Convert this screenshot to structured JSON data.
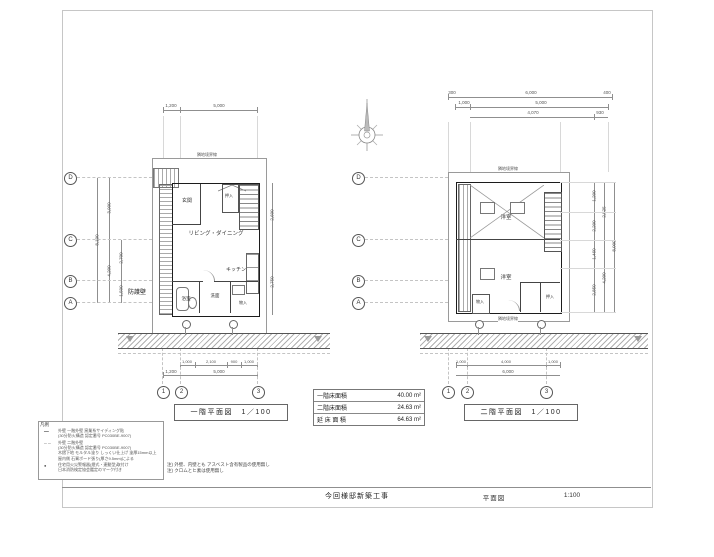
{
  "sheet": {
    "project_title": "今回様邸新築工事",
    "drawing_title": "平面図",
    "scale": "1:100"
  },
  "area_table": {
    "rows": [
      {
        "label": "一階床面積",
        "value": "40.00 m²"
      },
      {
        "label": "二階床面積",
        "value": "24.63 m²"
      },
      {
        "label": "延 床 面 積",
        "value": "64.63 m²"
      }
    ]
  },
  "plan1": {
    "caption": "一階平面図　1／100",
    "boundary_top": "隣地境界線",
    "guard_wall": "防護壁",
    "rooms": {
      "genkan": "玄関",
      "ld": "リビング・ダイニング",
      "kitchen": "キッチン",
      "oshiire": "押入",
      "bath": "浴室",
      "senmen": "洗面",
      "mono": "物入"
    },
    "grid": {
      "d": "D",
      "c": "C",
      "b": "B",
      "a": "A",
      "n1": "1",
      "n2": "2",
      "n3": "3"
    },
    "dims": {
      "top1": "1,200",
      "top2": "5,000",
      "left_total": "8,100",
      "left_u": "3,900",
      "left_l": "4,200",
      "left_l1": "2,700",
      "left_l2": "1,500",
      "right1": "2,600",
      "right2": "2,750",
      "b11": "1,000",
      "b12": "2,100",
      "b13": "900",
      "b14": "1,000",
      "b21": "1,200",
      "b22": "5,000"
    }
  },
  "plan2": {
    "caption": "二階平面図　1／100",
    "boundary_top": "隣地境界線",
    "boundary_bottom": "隣地境界線",
    "rooms": {
      "room_up": "洋室",
      "room_low": "洋室",
      "oshiire": "押入",
      "mono": "物入"
    },
    "grid": {
      "d": "D",
      "c": "C",
      "b": "B",
      "a": "A",
      "n1": "1",
      "n2": "2",
      "n3": "3"
    },
    "dims": {
      "t11": "300",
      "t12": "6,000",
      "t13": "400",
      "t21": "1,000",
      "t22": "5,000",
      "t31": "4,070",
      "t32": "930",
      "r11": "1,200",
      "r12": "2,200",
      "r13": "1,460",
      "r14": "2,850",
      "r21": "2,525",
      "r22": "4,200",
      "r3": "8,000",
      "b11": "1,000",
      "b12": "4,000",
      "b13": "1,000",
      "b2": "6,000"
    }
  },
  "legend": {
    "title": "凡例",
    "rows": [
      {
        "symbol": "━━",
        "text": "外壁 一階外壁 窯業系サイディング貼\n(30分防火構造 認定番号 PC030BE-9007)"
      },
      {
        "symbol": "─ ─",
        "text": "外壁 二階外壁\n(30分防火構造 認定番号 PC030BE-9007)\n木摺下地 モルタル塗り しっくい仕上げ 塗厚15mm以上\n屋内側 石膏ボード張り(厚さ9.5mm)による"
      },
      {
        "symbol": "●",
        "text": "住宅用火災警報器(煙式・連動型)取付け\n日本消防検定協会鑑定のマーク付き"
      }
    ]
  },
  "notes": "注) 外壁、内壁とも アスベスト含有製品の使用無し\n注) クロムとヒ素は使用無し"
}
